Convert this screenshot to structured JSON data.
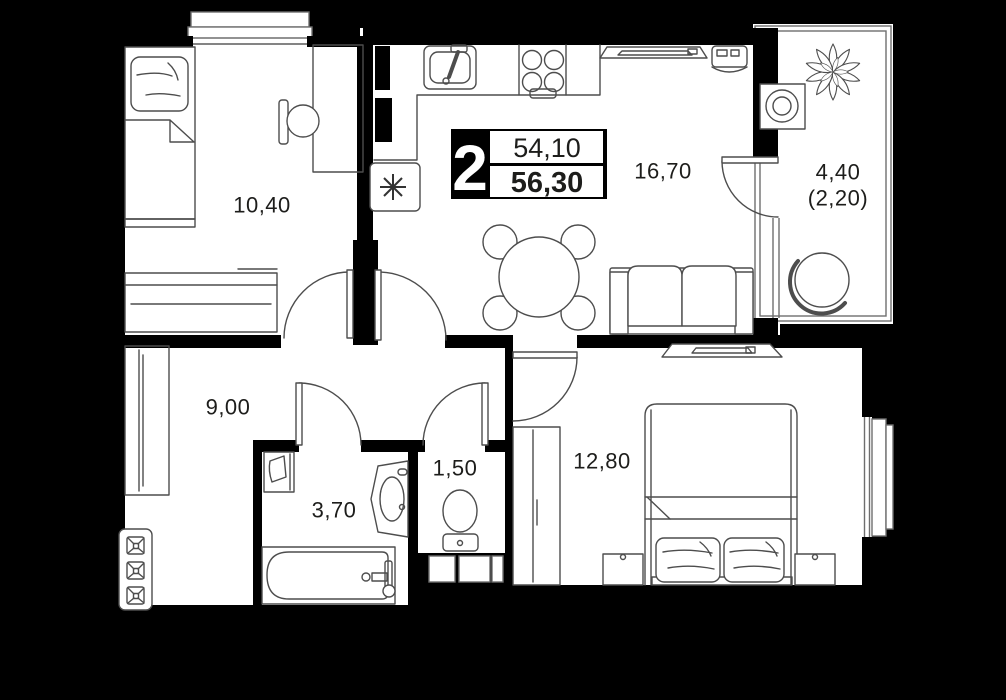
{
  "plan_title": "2-room apartment floor plan",
  "badge": {
    "rooms_count": "2",
    "living_area": "54,10",
    "total_area": "56,30"
  },
  "rooms": {
    "bedroom_small": "10,40",
    "kitchen_living": "16,70",
    "balcony_total": "4,40",
    "balcony_reduced": "(2,20)",
    "hallway": "9,00",
    "bathroom": "3,70",
    "toilet": "1,50",
    "bedroom_master": "12,80"
  },
  "colors": {
    "background": "#000000",
    "floor": "#ffffff",
    "wall": "#000000",
    "furniture_line": "#4d4d4d"
  }
}
